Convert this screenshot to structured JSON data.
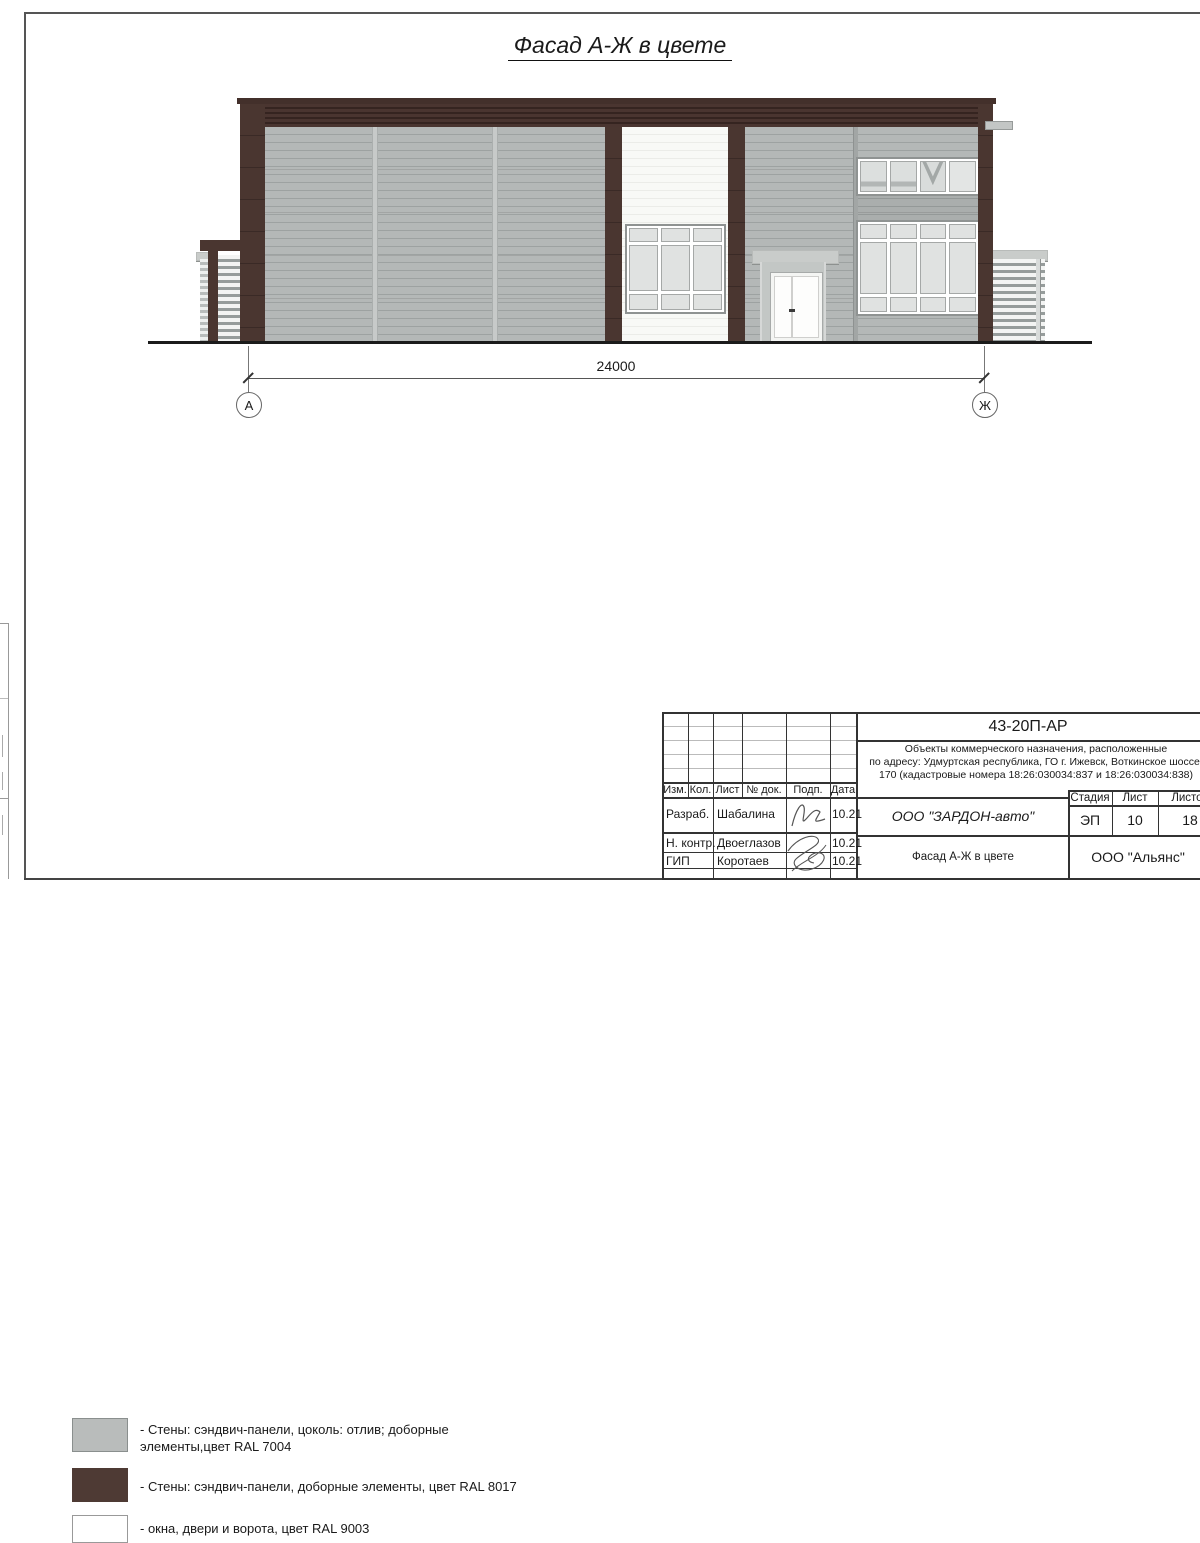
{
  "page": {
    "title": "Фасад А-Ж в цвете"
  },
  "drawing": {
    "dimension_label": "24000",
    "axis_left": "А",
    "axis_right": "Ж",
    "colors": {
      "wall_gray_ral7004": "#b3b7b6",
      "wall_brown_ral8017": "#4a3630",
      "openings_white_ral9003": "#f8f9f7"
    }
  },
  "legend": {
    "items": [
      {
        "name": "ral7004",
        "lines": [
          "- Стены: сэндвич-панели, цоколь: отлив; доборные",
          "элементы,цвет RAL 7004"
        ]
      },
      {
        "name": "ral8017",
        "lines": [
          "- Стены: сэндвич-панели, доборные элементы, цвет RAL 8017"
        ]
      },
      {
        "name": "ral9003",
        "lines": [
          "- окна, двери и ворота, цвет RAL 9003"
        ]
      }
    ]
  },
  "titleblock": {
    "doc_number": "43-20П-АР",
    "description_lines": [
      "Объекты коммерческого назначения, расположенные",
      "по адресу: Удмуртская республика, ГО г. Ижевск, Воткинское шоссе,",
      "170 (кадастровые номера 18:26:030034:837 и 18:26:030034:838)"
    ],
    "header_cols": {
      "izm": "Изм.",
      "kol": "Кол.",
      "list": "Лист",
      "doc": "№ док.",
      "podp": "Подп.",
      "data": "Дата"
    },
    "people": [
      {
        "role": "Разраб.",
        "name": "Шабалина",
        "date": "10.21"
      },
      {
        "role": "Н. контр.",
        "name": "Двоеглазов",
        "date": "10.21"
      },
      {
        "role": "ГИП",
        "name": "Коротаев",
        "date": "10.21"
      }
    ],
    "org": "ООО \"ЗАРДОН-авто\"",
    "stage_label": "Стадия",
    "sheet_label": "Лист",
    "sheets_label": "Листов",
    "stage": "ЭП",
    "sheet": "10",
    "sheets": "18",
    "drawing_name": "Фасад А-Ж в цвете",
    "contractor": "ООО \"Альянс\""
  }
}
